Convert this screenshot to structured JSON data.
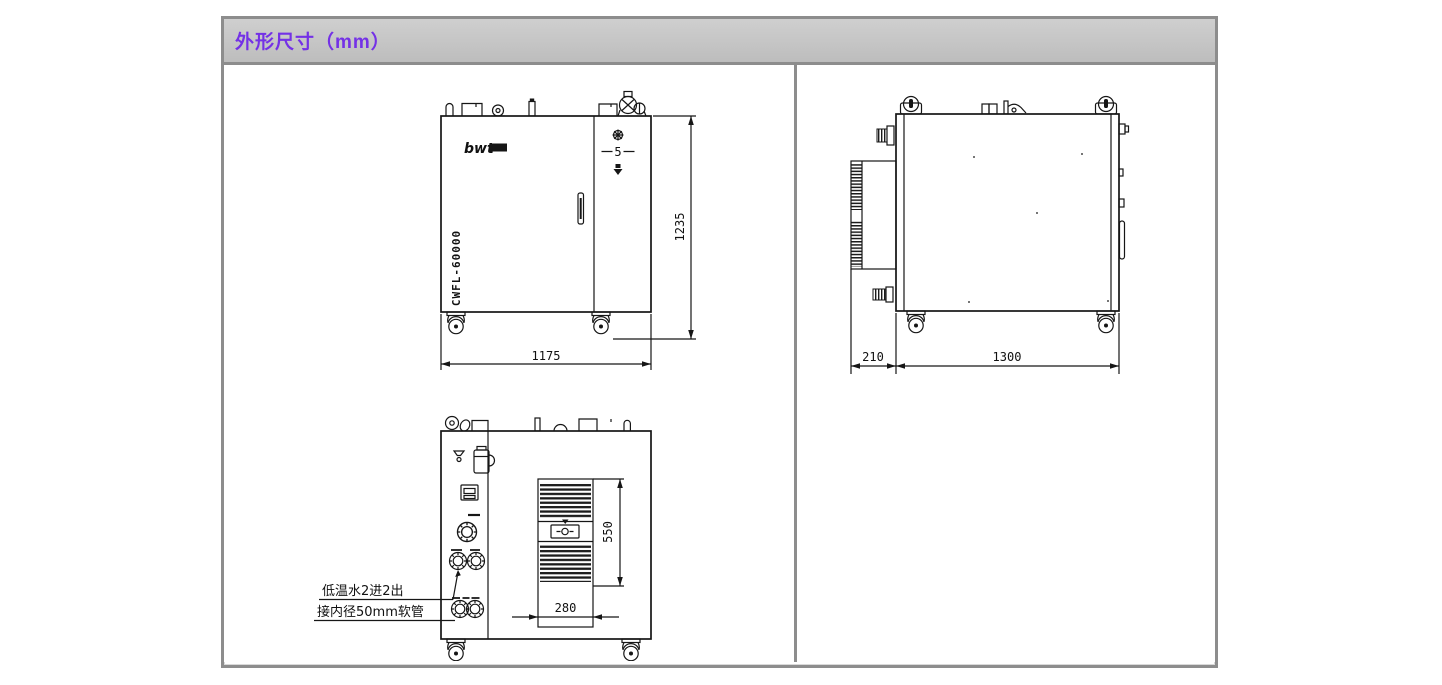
{
  "header": {
    "title": "外形尺寸（mm）"
  },
  "front_view": {
    "brand": "bwt",
    "model": "CWFL-60000",
    "display_value": "5",
    "dim_width": "1175",
    "dim_height": "1235"
  },
  "side_view": {
    "dim_rear_offset": "210",
    "dim_depth": "1300"
  },
  "rear_view": {
    "dim_vent_width": "280",
    "dim_vent_height": "550",
    "note_line1": "低温水2进2出",
    "note_line2": "接内径50mm软管"
  }
}
